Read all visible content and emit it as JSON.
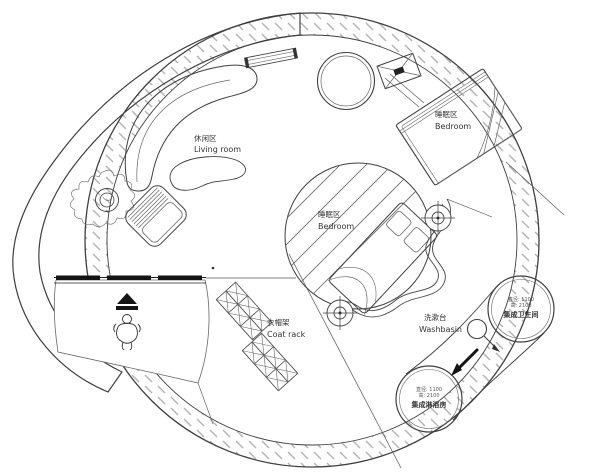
{
  "labels": {
    "living": {
      "zh": "休闲区",
      "en": "Living room"
    },
    "bedroom_upper": {
      "zh": "睡眠区",
      "en": "Bedroom"
    },
    "bedroom_center": {
      "zh": "睡眠区",
      "en": "Bedroom"
    },
    "coat_rack": {
      "zh": "衣帽架",
      "en": "Coat rack"
    },
    "washbasin": {
      "zh": "洗漱台",
      "en": "Washbasin"
    },
    "bathroom_pod": {
      "spec1": "直径: 1100",
      "spec2": "高: 2100",
      "name": "集成卫生间"
    },
    "shower_pod": {
      "spec1": "直径: 1100",
      "spec2": "高: 2100",
      "name": "集成淋浴房"
    }
  },
  "colors": {
    "line": "#3f3f3f",
    "wall_hatch": "#b3b3b3",
    "deck_hatch": "#c6c6c6",
    "text": "#333333",
    "black_fill": "#141414",
    "background": "#ffffff"
  }
}
